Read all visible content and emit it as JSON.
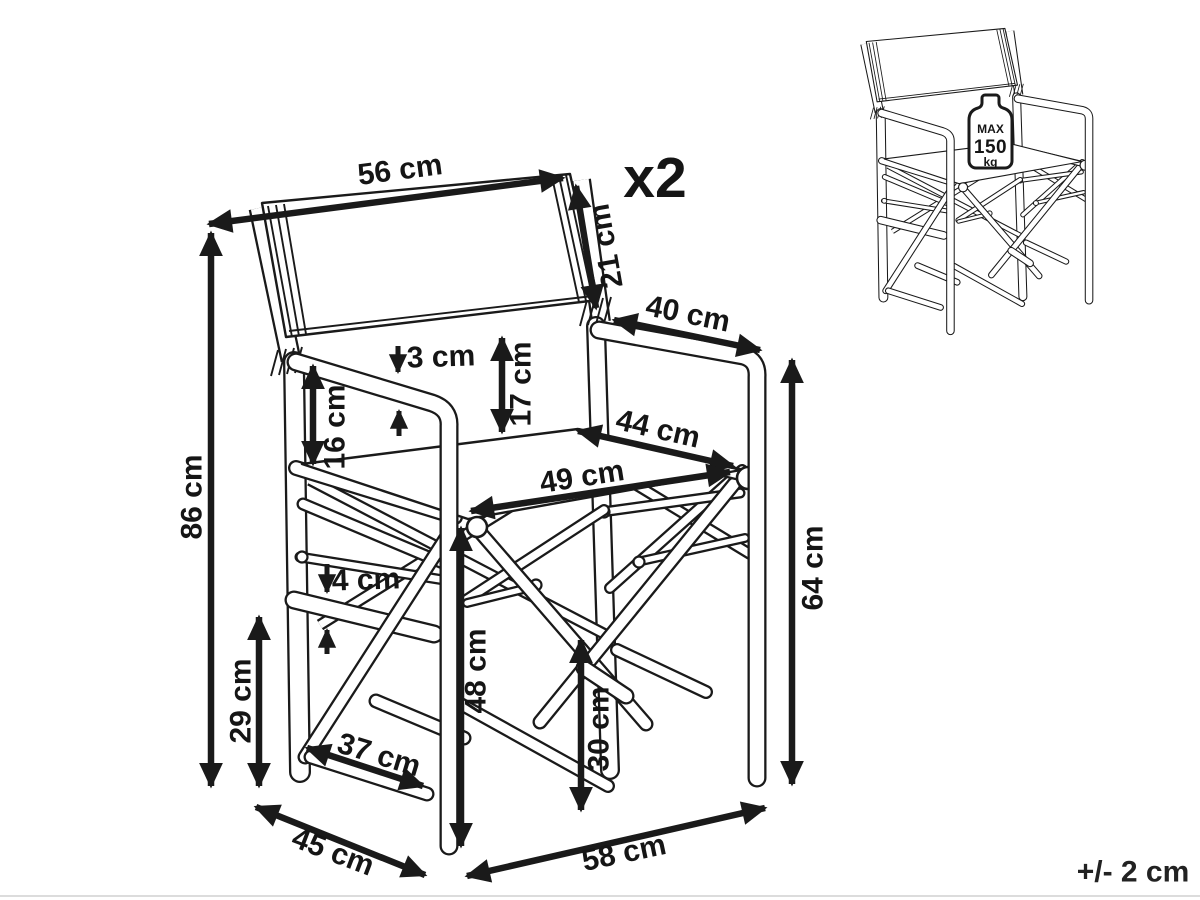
{
  "figure": {
    "product": "folding director's chair dimension diagram",
    "quantity": "x2",
    "tolerance": "+/- 2 cm",
    "unit": "cm",
    "line_color": "#1a1a1a",
    "background_color": "#ffffff"
  },
  "weight_badge": {
    "max": "MAX",
    "value": "150",
    "unit": "kg"
  },
  "dims": {
    "backrest_width": {
      "label": "56 cm"
    },
    "backrest_side": {
      "label": "21 cm"
    },
    "armrest_length": {
      "label": "40 cm"
    },
    "armrest_thickness": {
      "label": "3 cm"
    },
    "backrest_to_seat": {
      "label": "17 cm"
    },
    "armrest_to_rail": {
      "label": "16 cm"
    },
    "seat_depth": {
      "label": "44 cm"
    },
    "seat_width": {
      "label": "49 cm"
    },
    "total_height": {
      "label": "86 cm"
    },
    "armrest_height": {
      "label": "64 cm"
    },
    "rung_thickness": {
      "label": "4 cm"
    },
    "rung_height": {
      "label": "29 cm"
    },
    "seat_front_height": {
      "label": "48 cm"
    },
    "brace_to_floor": {
      "label": "30 cm"
    },
    "rung_length": {
      "label": "37 cm"
    },
    "base_depth": {
      "label": "45 cm"
    },
    "base_width": {
      "label": "58 cm"
    }
  }
}
